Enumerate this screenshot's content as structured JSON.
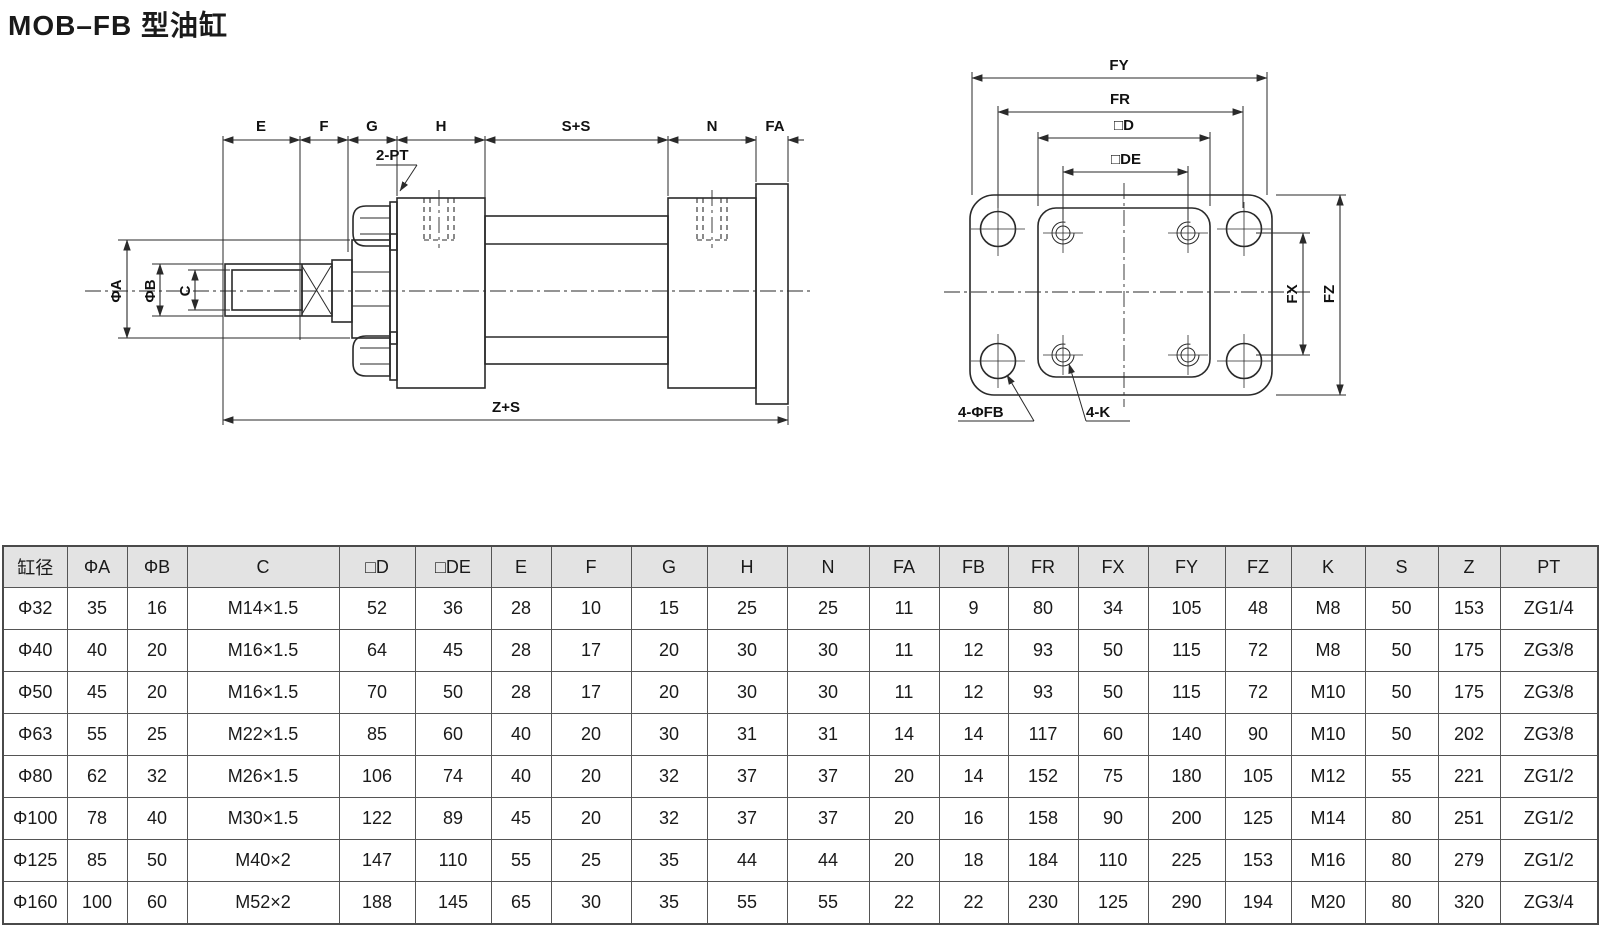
{
  "page": {
    "title": "MOB–FB 型油缸"
  },
  "colors": {
    "line": "#2a2a2a",
    "text": "#1a1a1a",
    "table_border": "#555555",
    "header_bg": "#e3e3e3",
    "background": "#ffffff"
  },
  "drawing_side": {
    "dims_top": [
      "E",
      "F",
      "G",
      "H",
      "S+S",
      "N",
      "FA"
    ],
    "dims_left": [
      "ΦA",
      "ΦB",
      "C"
    ],
    "dim_bottom": "Z+S",
    "port_label": "2-PT"
  },
  "drawing_front": {
    "dims_top": [
      "FY",
      "FR",
      "□D",
      "□DE"
    ],
    "dims_right": [
      "FX",
      "FZ"
    ],
    "hole_labels": [
      "4-ΦFB",
      "4-K"
    ]
  },
  "table": {
    "headers": [
      "缸径",
      "ΦA",
      "ΦB",
      "C",
      "□D",
      "□DE",
      "E",
      "F",
      "G",
      "H",
      "N",
      "FA",
      "FB",
      "FR",
      "FX",
      "FY",
      "FZ",
      "K",
      "S",
      "Z",
      "PT"
    ],
    "rows": [
      [
        "Φ32",
        "35",
        "16",
        "M14×1.5",
        "52",
        "36",
        "28",
        "10",
        "15",
        "25",
        "25",
        "11",
        "9",
        "80",
        "34",
        "105",
        "48",
        "M8",
        "50",
        "153",
        "ZG1/4"
      ],
      [
        "Φ40",
        "40",
        "20",
        "M16×1.5",
        "64",
        "45",
        "28",
        "17",
        "20",
        "30",
        "30",
        "11",
        "12",
        "93",
        "50",
        "115",
        "72",
        "M8",
        "50",
        "175",
        "ZG3/8"
      ],
      [
        "Φ50",
        "45",
        "20",
        "M16×1.5",
        "70",
        "50",
        "28",
        "17",
        "20",
        "30",
        "30",
        "11",
        "12",
        "93",
        "50",
        "115",
        "72",
        "M10",
        "50",
        "175",
        "ZG3/8"
      ],
      [
        "Φ63",
        "55",
        "25",
        "M22×1.5",
        "85",
        "60",
        "40",
        "20",
        "30",
        "31",
        "31",
        "14",
        "14",
        "117",
        "60",
        "140",
        "90",
        "M10",
        "50",
        "202",
        "ZG3/8"
      ],
      [
        "Φ80",
        "62",
        "32",
        "M26×1.5",
        "106",
        "74",
        "40",
        "20",
        "32",
        "37",
        "37",
        "20",
        "14",
        "152",
        "75",
        "180",
        "105",
        "M12",
        "55",
        "221",
        "ZG1/2"
      ],
      [
        "Φ100",
        "78",
        "40",
        "M30×1.5",
        "122",
        "89",
        "45",
        "20",
        "32",
        "37",
        "37",
        "20",
        "16",
        "158",
        "90",
        "200",
        "125",
        "M14",
        "80",
        "251",
        "ZG1/2"
      ],
      [
        "Φ125",
        "85",
        "50",
        "M40×2",
        "147",
        "110",
        "55",
        "25",
        "35",
        "44",
        "44",
        "20",
        "18",
        "184",
        "110",
        "225",
        "153",
        "M16",
        "80",
        "279",
        "ZG1/2"
      ],
      [
        "Φ160",
        "100",
        "60",
        "M52×2",
        "188",
        "145",
        "65",
        "30",
        "35",
        "55",
        "55",
        "22",
        "22",
        "230",
        "125",
        "290",
        "194",
        "M20",
        "80",
        "320",
        "ZG3/4"
      ]
    ]
  }
}
